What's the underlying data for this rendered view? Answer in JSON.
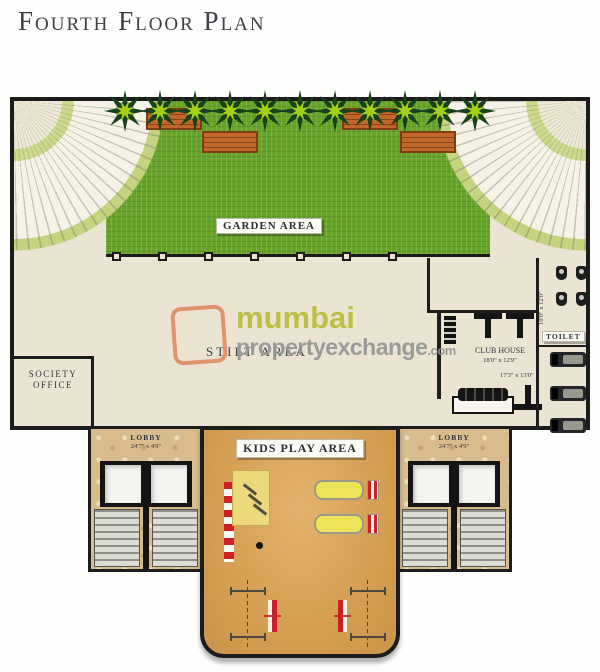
{
  "title": "Fourth Floor Plan",
  "watermark": {
    "brand_top": "mumbai",
    "brand_bottom": "propertyexchange",
    "brand_tld": ".com"
  },
  "areas": {
    "garden": "GARDEN AREA",
    "stilt": "STILT AREA",
    "kids_play": "KIDS PLAY AREA",
    "society_line1": "SOCIETY",
    "society_line2": "OFFICE",
    "club_house": "CLUB HOUSE",
    "club_house_dims": "18'0\" x 12'9\"",
    "gym_dims": "17'3\" x 13'0\"",
    "toilet": "TOILET",
    "toilet_dims": "10'0\" x 12'0\"",
    "lobby_left": "LOBBY",
    "lobby_left_dims": "24'7\" x 4'9\"",
    "lobby_right": "LOBBY",
    "lobby_right_dims": "24'7\" x 4'9\""
  },
  "colors": {
    "lawn_green": "#69a42a",
    "palm_bright": "#a5d114",
    "wall_black": "#1c1c1c",
    "floor_cream": "#ece4d2",
    "lobby_marble": "#d9bc8d",
    "play_sand": "#d29c50",
    "bench_orange": "#c2672a",
    "stripe_red": "#cf2026",
    "brand_green": "#b6bf3b",
    "brand_gray": "#949494",
    "logo_orange": "#e08e63"
  }
}
